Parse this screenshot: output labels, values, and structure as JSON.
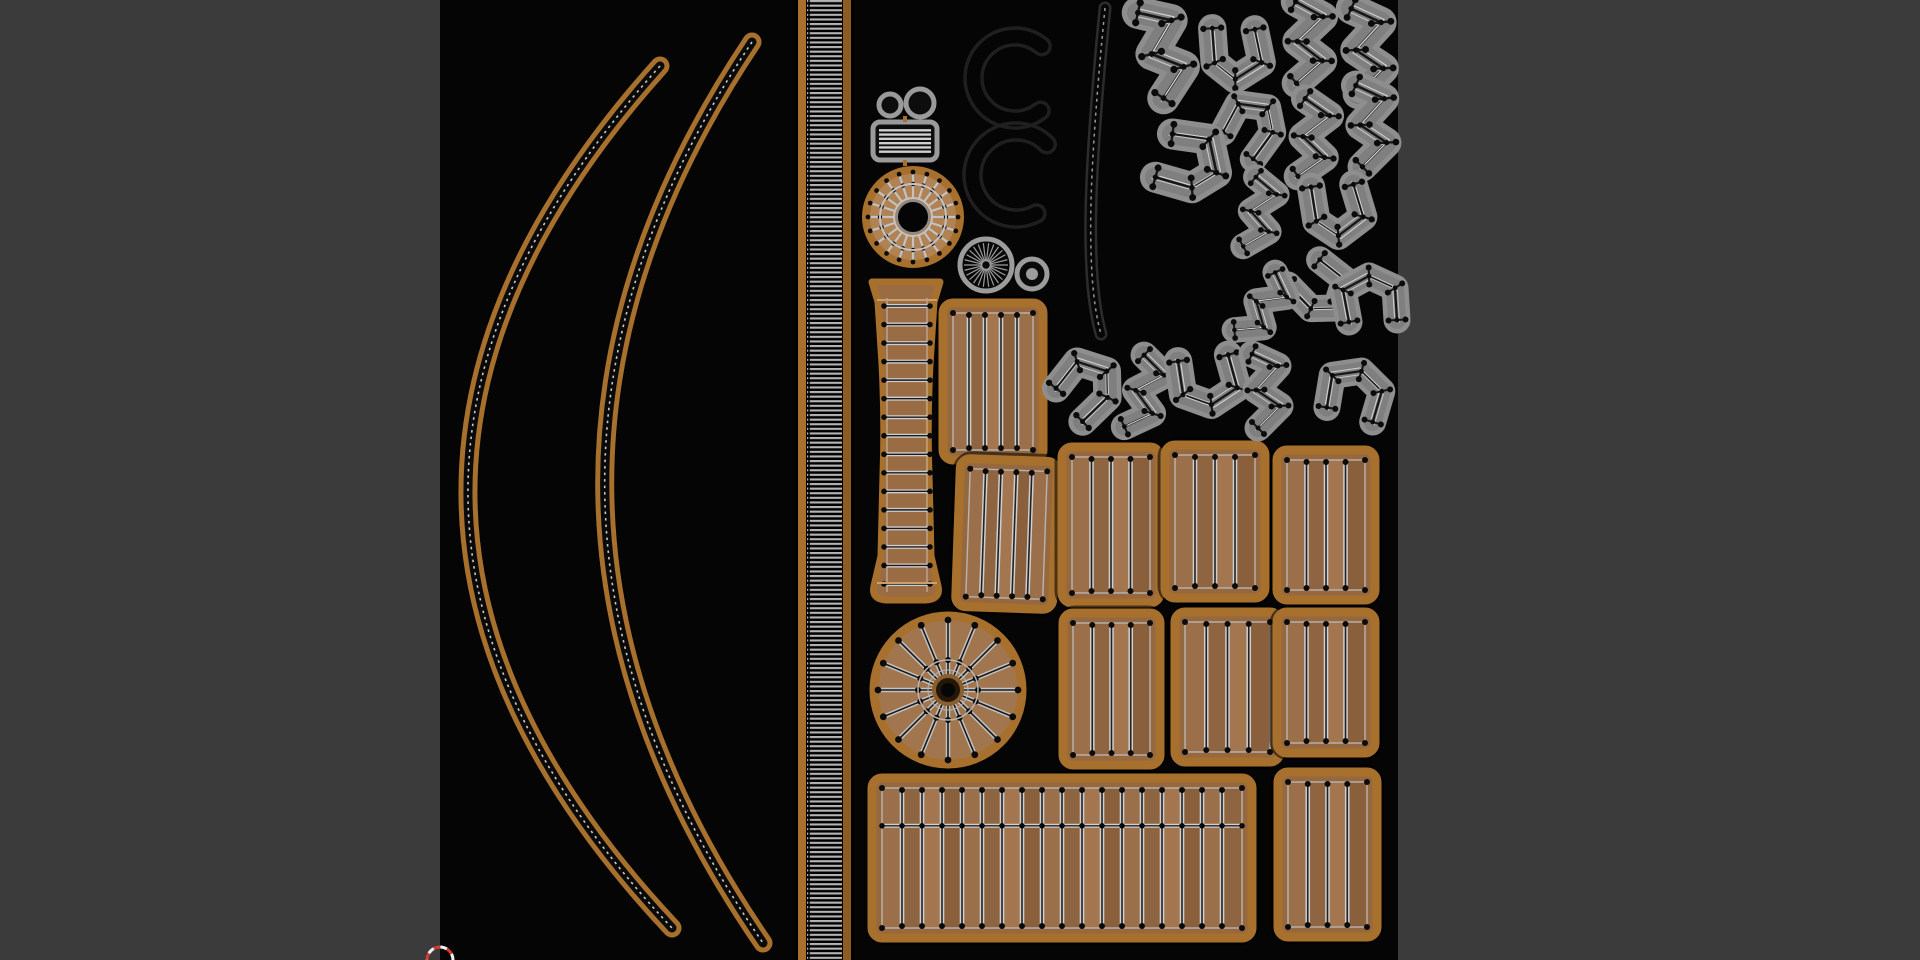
{
  "app": {
    "name": "uv-texture-editor-viewport"
  },
  "colors": {
    "editor_bg": "#3b3b3c",
    "texture_bg": "#050505",
    "tan": "#a8702d",
    "tan_bright": "#bc8038",
    "wood": "#96683f",
    "wood_shades": [
      "#9b6f4a",
      "#8f6440",
      "#a3764f",
      "#8a5f3c"
    ],
    "line_light": "#cfcfcf",
    "line_mid": "#bdbdbd",
    "line_dark": "#161616",
    "dot": "#0b0b0b",
    "island_gray": "#8e8e8e",
    "island_gray_dark": "#7f7f7f",
    "outline_dark": "#1f1f1f",
    "ray_gray": "#9c9c9c",
    "accent_white": "#e2e2e2",
    "rung_gray": "#b5b5b5",
    "cursor_red": "#d63a2f",
    "cursor_white": "#efefef"
  },
  "texture": {
    "x": 440,
    "y": 0,
    "w": 958,
    "h": 960
  },
  "arcs": [
    {
      "d": "M660,66 Q270,500 672,928"
    },
    {
      "d": "M752,42 Q452,490 763,943"
    }
  ],
  "ladder": {
    "x": 798,
    "w": 53,
    "border": 8
  },
  "plank_rects": [
    {
      "x": 943,
      "y": 303,
      "w": 100,
      "h": 157,
      "n": 4,
      "rot": 0
    },
    {
      "x": 958,
      "y": 460,
      "w": 97,
      "h": 148,
      "n": 4,
      "rot": 2
    },
    {
      "x": 1062,
      "y": 447,
      "w": 98,
      "h": 156,
      "n": 3,
      "rot": 0
    },
    {
      "x": 1165,
      "y": 445,
      "w": 100,
      "h": 153,
      "n": 3,
      "rot": 0
    },
    {
      "x": 1277,
      "y": 450,
      "w": 98,
      "h": 150,
      "n": 3,
      "rot": 0
    },
    {
      "x": 1063,
      "y": 613,
      "w": 97,
      "h": 152,
      "n": 3,
      "rot": 0
    },
    {
      "x": 1175,
      "y": 612,
      "w": 105,
      "h": 150,
      "n": 3,
      "rot": 0
    },
    {
      "x": 1277,
      "y": 612,
      "w": 98,
      "h": 141,
      "n": 3,
      "rot": 0
    },
    {
      "x": 1278,
      "y": 772,
      "w": 99,
      "h": 165,
      "n": 3,
      "rot": 0
    },
    {
      "x": 872,
      "y": 778,
      "w": 380,
      "h": 160,
      "n": 17,
      "rot": 0,
      "hline": 0.27
    }
  ],
  "tube": {
    "d": "M872,282 L940,282 L934,302 L930,364 Q927,420 929,475 L931,556 L938,586 Q941,599 926,600 L886,600 Q871,599 874,586 L881,556 L883,475 Q885,420 882,364 L878,302 Z",
    "rx1": 884,
    "rx2": 930,
    "ry1": 306,
    "ry2": 584,
    "rungs": 16,
    "seams": [
      300,
      583
    ]
  },
  "wheels": {
    "big": {
      "cx": 948,
      "cy": 690,
      "r": 78,
      "spokes": 16
    },
    "top": {
      "cx": 913,
      "cy": 217,
      "r": 50,
      "spokes": 20
    },
    "starburst": {
      "cx": 986,
      "cy": 265,
      "r": 26,
      "rays": 26
    },
    "small_ring": {
      "cx": 1032,
      "cy": 274,
      "r": 15
    }
  },
  "pair_circles": [
    {
      "cx": 890,
      "cy": 105,
      "r": 11
    },
    {
      "cx": 920,
      "cy": 103,
      "r": 14
    }
  ],
  "louver": {
    "x": 873,
    "y": 122,
    "w": 64,
    "h": 38,
    "stripes": 6
  },
  "c_shapes": [
    {
      "cx": 1015,
      "cy": 78,
      "r1": 50,
      "r2": 33,
      "a1": 52,
      "sweep": 258
    },
    {
      "cx": 1016,
      "cy": 175,
      "r1": 52,
      "r2": 35,
      "a1": 62,
      "sweep": 253
    }
  ],
  "thin_strip": {
    "d": "M1105,8 C1096,100 1089,190 1091,250 C1092,295 1097,320 1101,334"
  },
  "island_tpls": {
    "s": [
      [
        -12,
        -36
      ],
      [
        14,
        -24
      ],
      [
        -8,
        0
      ],
      [
        16,
        16
      ],
      [
        -6,
        38
      ]
    ],
    "j": [
      [
        -28,
        -18
      ],
      [
        2,
        -30
      ],
      [
        22,
        -8
      ],
      [
        10,
        14
      ],
      [
        -22,
        22
      ]
    ],
    "c": [
      [
        -22,
        -24
      ],
      [
        10,
        -30
      ],
      [
        24,
        -4
      ],
      [
        12,
        22
      ],
      [
        -20,
        24
      ]
    ]
  },
  "islands": [
    {
      "t": "s",
      "x": 1161,
      "y": 52,
      "r": -12,
      "sc": 1.2
    },
    {
      "t": "j",
      "x": 1231,
      "y": 55,
      "r": 100,
      "sc": 1.05
    },
    {
      "t": "s",
      "x": 1306,
      "y": 42,
      "r": 4,
      "sc": 1.1
    },
    {
      "t": "s",
      "x": 1365,
      "y": 50,
      "r": 0,
      "sc": 1.15
    },
    {
      "t": "j",
      "x": 1256,
      "y": 128,
      "r": -40,
      "sc": 1.0
    },
    {
      "t": "s",
      "x": 1311,
      "y": 138,
      "r": 10,
      "sc": 1.05
    },
    {
      "t": "s",
      "x": 1369,
      "y": 125,
      "r": 0,
      "sc": 1.1
    },
    {
      "t": "j",
      "x": 1190,
      "y": 168,
      "r": 30,
      "sc": 1.15
    },
    {
      "t": "s",
      "x": 1258,
      "y": 213,
      "r": 15,
      "sc": 0.95
    },
    {
      "t": "j",
      "x": 1332,
      "y": 212,
      "r": 95,
      "sc": 1.05
    },
    {
      "t": "j",
      "x": 1318,
      "y": 293,
      "r": 60,
      "sc": 1.0
    },
    {
      "t": "c",
      "x": 1373,
      "y": 300,
      "r": -90,
      "sc": 1.0
    },
    {
      "t": "s",
      "x": 1262,
      "y": 306,
      "r": 40,
      "sc": 0.95
    },
    {
      "t": "j",
      "x": 1091,
      "y": 390,
      "r": -30,
      "sc": 1.05
    },
    {
      "t": "s",
      "x": 1143,
      "y": 393,
      "r": 20,
      "sc": 1.0
    },
    {
      "t": "c",
      "x": 1205,
      "y": 380,
      "r": 85,
      "sc": 1.05
    },
    {
      "t": "s",
      "x": 1264,
      "y": 390,
      "r": 0,
      "sc": 1.0
    },
    {
      "t": "c",
      "x": 1357,
      "y": 395,
      "r": -70,
      "sc": 1.0
    }
  ],
  "cursor": {
    "x": 440,
    "y": 960,
    "r": 13
  }
}
